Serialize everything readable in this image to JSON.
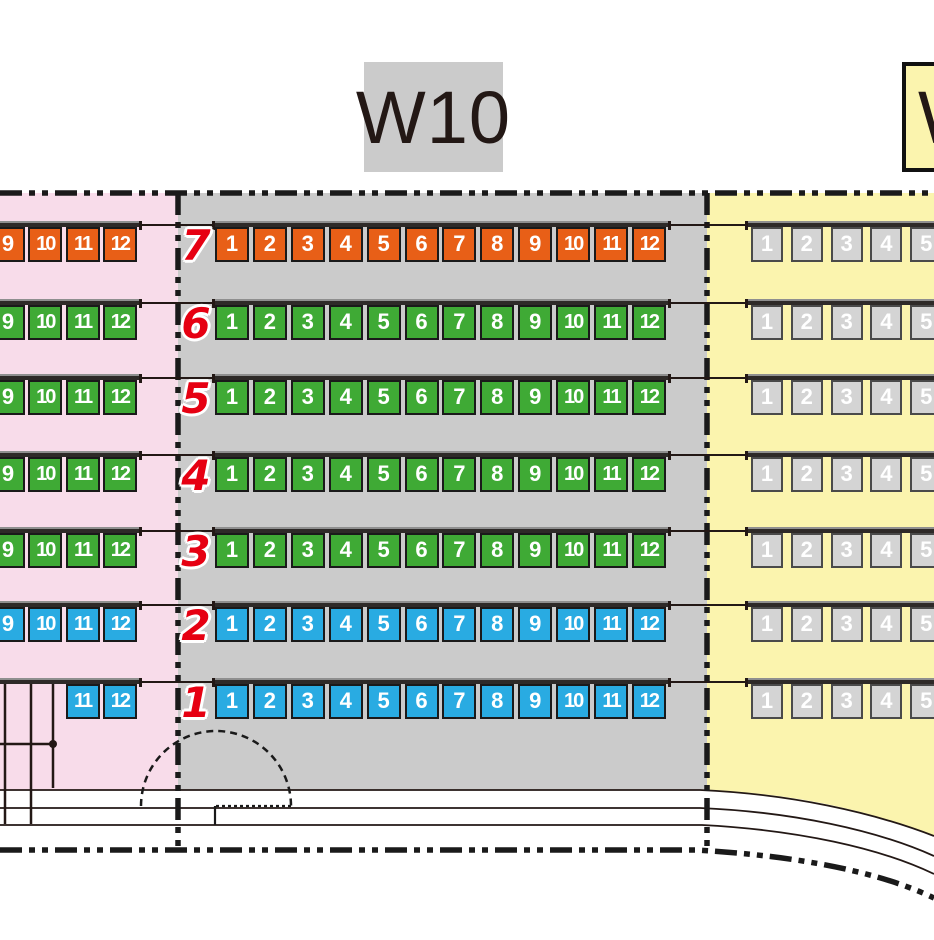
{
  "blocks": {
    "center_label": "W10",
    "right_label": "W"
  },
  "colors": {
    "orange": "#e85f17",
    "green": "#3faa35",
    "blue": "#29abe2",
    "unavailable": "#d4d4d4",
    "pink_bg": "#f8dcea",
    "gray_bg": "#cbcbcb",
    "yellow_bg": "#fbf4ae",
    "row_number_red": "#e60012",
    "line": "#231815"
  },
  "sections": {
    "left": {
      "name": "left-block",
      "show_row_numbers": false,
      "rows": [
        {
          "row": "7",
          "color": "orange",
          "seats": [
            "9",
            "10",
            "11",
            "12"
          ]
        },
        {
          "row": "6",
          "color": "green",
          "seats": [
            "9",
            "10",
            "11",
            "12"
          ]
        },
        {
          "row": "5",
          "color": "green",
          "seats": [
            "9",
            "10",
            "11",
            "12"
          ]
        },
        {
          "row": "4",
          "color": "green",
          "seats": [
            "9",
            "10",
            "11",
            "12"
          ]
        },
        {
          "row": "3",
          "color": "green",
          "seats": [
            "9",
            "10",
            "11",
            "12"
          ]
        },
        {
          "row": "2",
          "color": "blue",
          "seats": [
            "9",
            "10",
            "11",
            "12"
          ]
        },
        {
          "row": "1",
          "color": "blue",
          "seats": [
            "11",
            "12"
          ]
        }
      ]
    },
    "center": {
      "name": "block-W10",
      "show_row_numbers": true,
      "rows": [
        {
          "row": "7",
          "color": "orange",
          "seats": [
            "1",
            "2",
            "3",
            "4",
            "5",
            "6",
            "7",
            "8",
            "9",
            "10",
            "11",
            "12"
          ]
        },
        {
          "row": "6",
          "color": "green",
          "seats": [
            "1",
            "2",
            "3",
            "4",
            "5",
            "6",
            "7",
            "8",
            "9",
            "10",
            "11",
            "12"
          ]
        },
        {
          "row": "5",
          "color": "green",
          "seats": [
            "1",
            "2",
            "3",
            "4",
            "5",
            "6",
            "7",
            "8",
            "9",
            "10",
            "11",
            "12"
          ]
        },
        {
          "row": "4",
          "color": "green",
          "seats": [
            "1",
            "2",
            "3",
            "4",
            "5",
            "6",
            "7",
            "8",
            "9",
            "10",
            "11",
            "12"
          ]
        },
        {
          "row": "3",
          "color": "green",
          "seats": [
            "1",
            "2",
            "3",
            "4",
            "5",
            "6",
            "7",
            "8",
            "9",
            "10",
            "11",
            "12"
          ]
        },
        {
          "row": "2",
          "color": "blue",
          "seats": [
            "1",
            "2",
            "3",
            "4",
            "5",
            "6",
            "7",
            "8",
            "9",
            "10",
            "11",
            "12"
          ]
        },
        {
          "row": "1",
          "color": "blue",
          "seats": [
            "1",
            "2",
            "3",
            "4",
            "5",
            "6",
            "7",
            "8",
            "9",
            "10",
            "11",
            "12"
          ]
        }
      ]
    },
    "right": {
      "name": "right-block",
      "show_row_numbers": false,
      "rows": [
        {
          "row": "7",
          "color": "unavailable",
          "seats": [
            "1",
            "2",
            "3",
            "4",
            "5"
          ]
        },
        {
          "row": "6",
          "color": "unavailable",
          "seats": [
            "1",
            "2",
            "3",
            "4",
            "5"
          ]
        },
        {
          "row": "5",
          "color": "unavailable",
          "seats": [
            "1",
            "2",
            "3",
            "4",
            "5"
          ]
        },
        {
          "row": "4",
          "color": "unavailable",
          "seats": [
            "1",
            "2",
            "3",
            "4",
            "5"
          ]
        },
        {
          "row": "3",
          "color": "unavailable",
          "seats": [
            "1",
            "2",
            "3",
            "4",
            "5"
          ]
        },
        {
          "row": "2",
          "color": "unavailable",
          "seats": [
            "1",
            "2",
            "3",
            "4",
            "5"
          ]
        },
        {
          "row": "1",
          "color": "unavailable",
          "seats": [
            "1",
            "2",
            "3",
            "4",
            "5"
          ]
        }
      ]
    }
  }
}
